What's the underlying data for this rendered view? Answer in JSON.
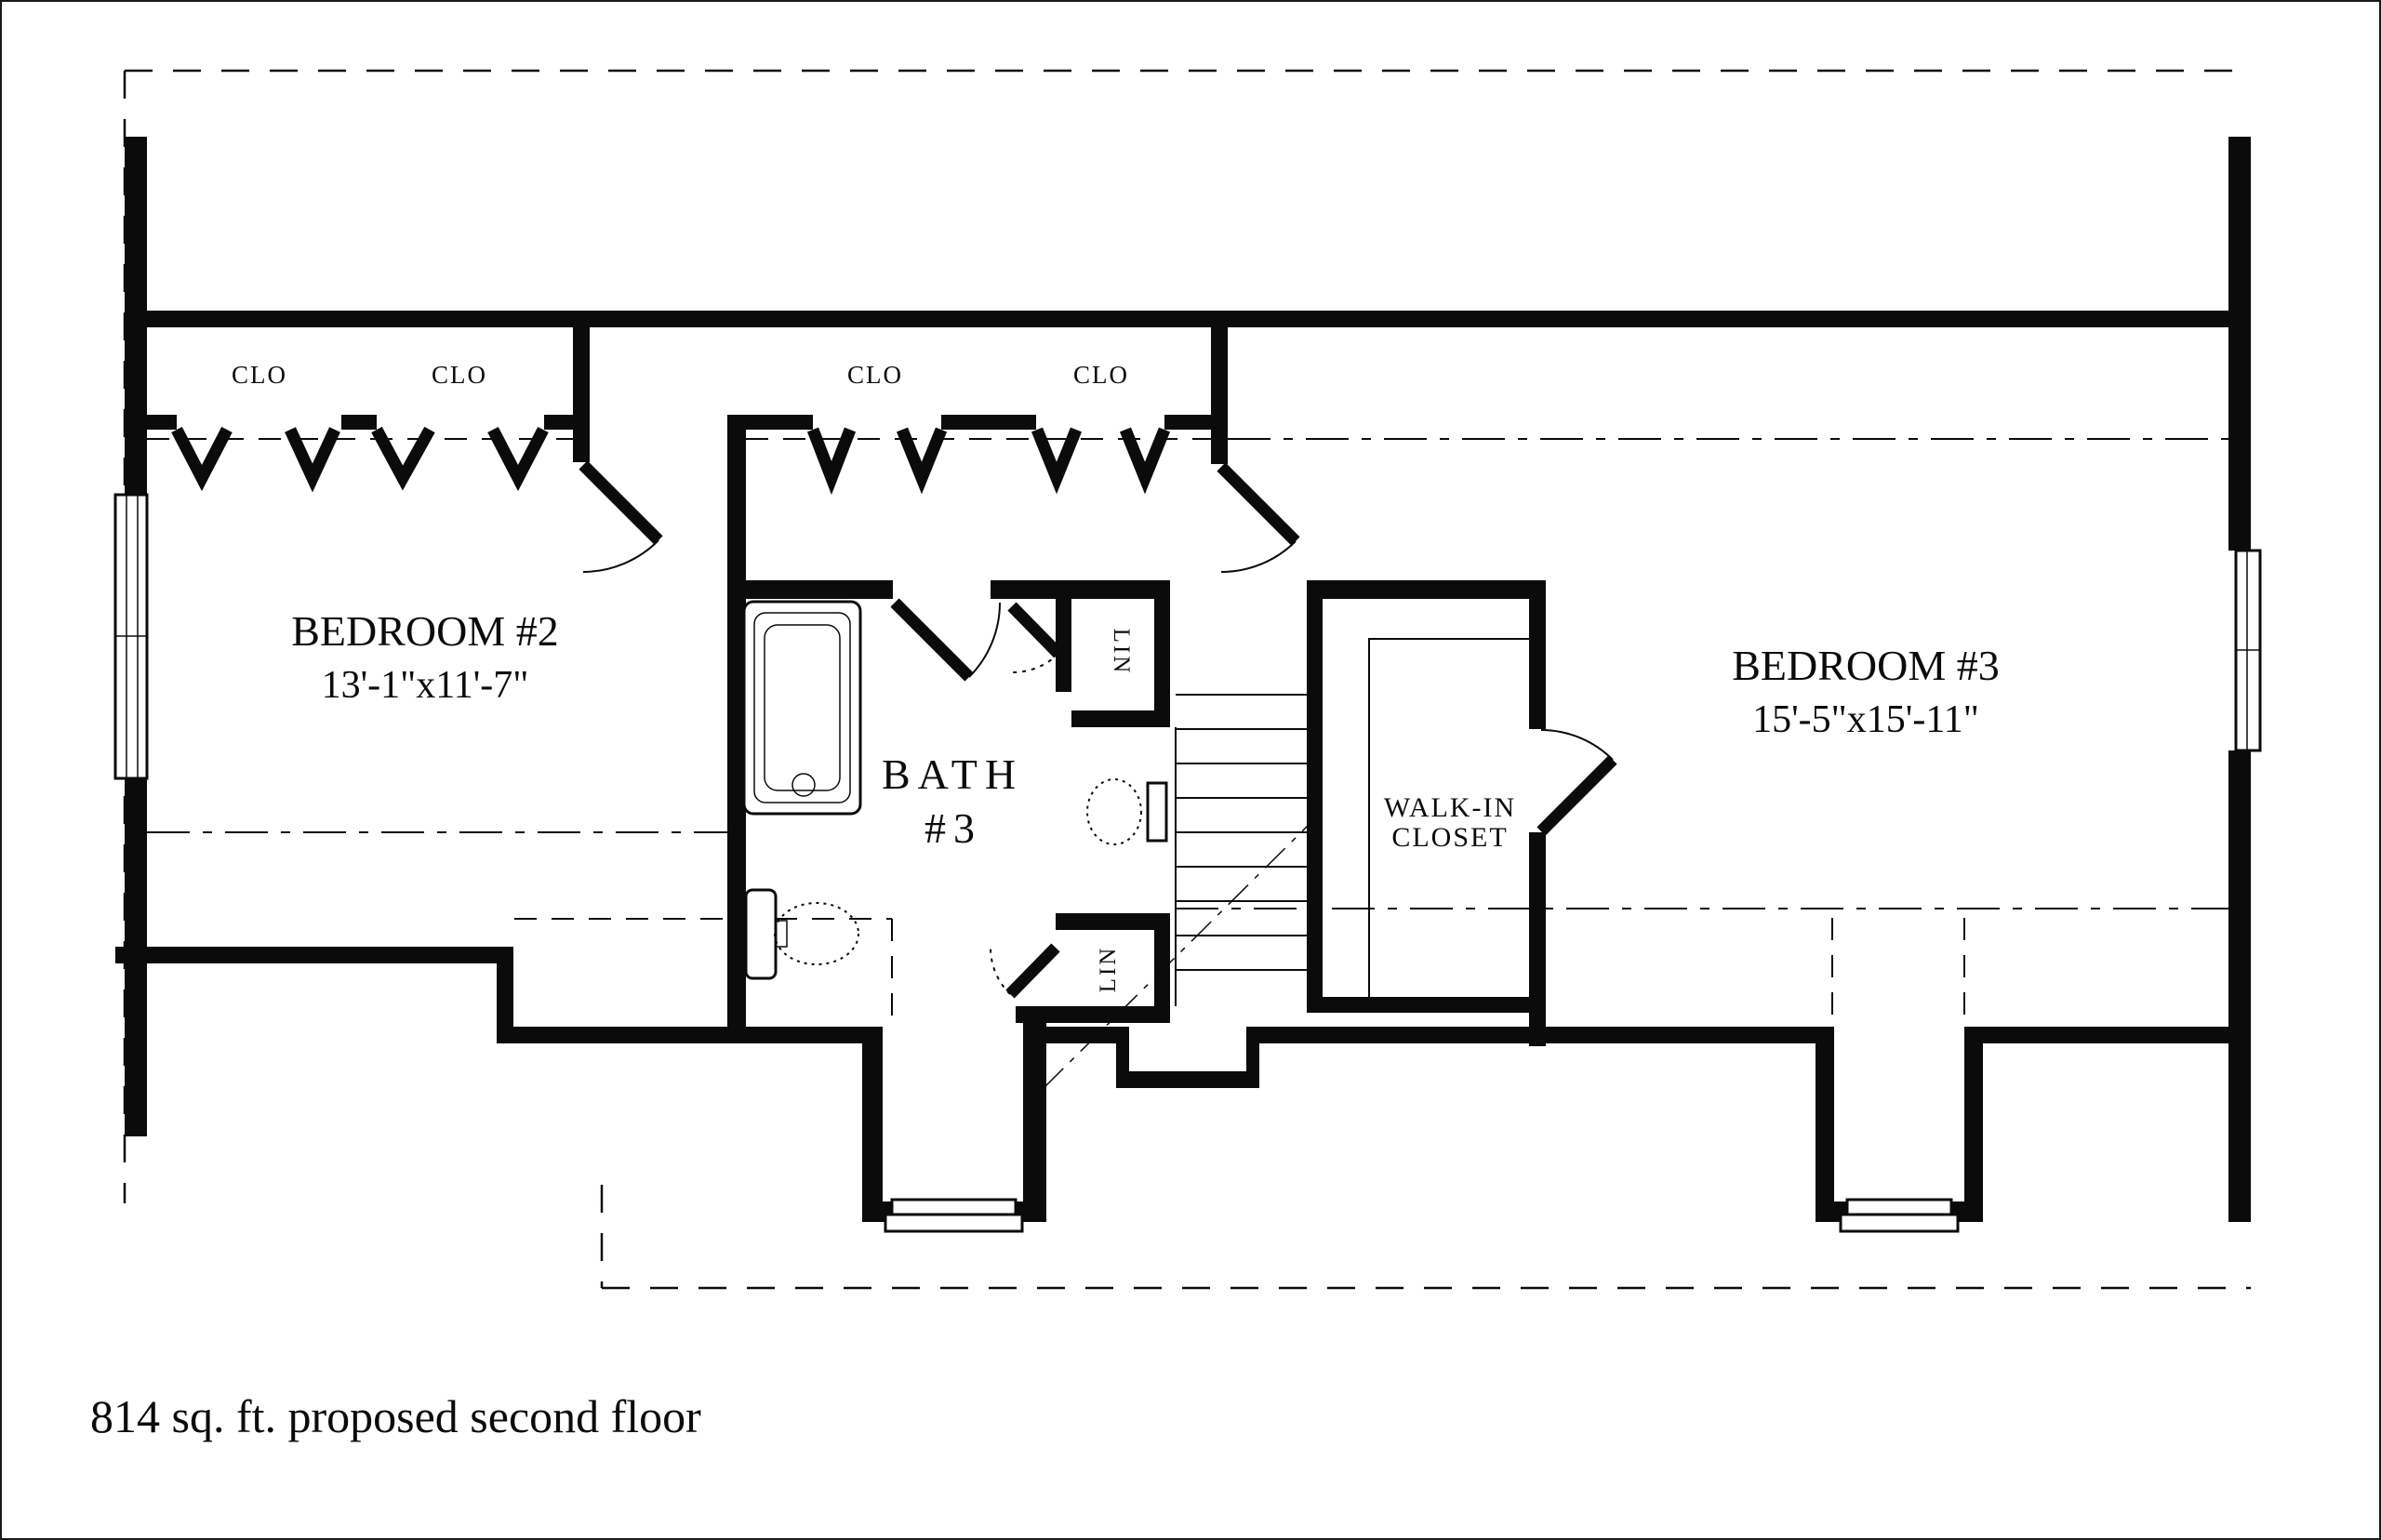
{
  "page": {
    "footer": "814 sq. ft. proposed second floor"
  },
  "colors": {
    "ink": "#0b0b0b",
    "paper": "#ffffff"
  },
  "rooms": {
    "bedroom2": {
      "name": "BEDROOM #2",
      "dims": "13'-1\"x11'-7\""
    },
    "bedroom3": {
      "name": "BEDROOM #3",
      "dims": "15'-5\"x15'-11\""
    },
    "bath": {
      "line1": "BATH",
      "line2": "#3"
    },
    "walkin": {
      "line1": "WALK-IN",
      "line2": "CLOSET"
    },
    "closets": {
      "clo1": "CLO",
      "clo2": "CLO",
      "clo3": "CLO",
      "clo4": "CLO",
      "lin_top": "LIN",
      "lin_bottom": "LIN"
    }
  }
}
